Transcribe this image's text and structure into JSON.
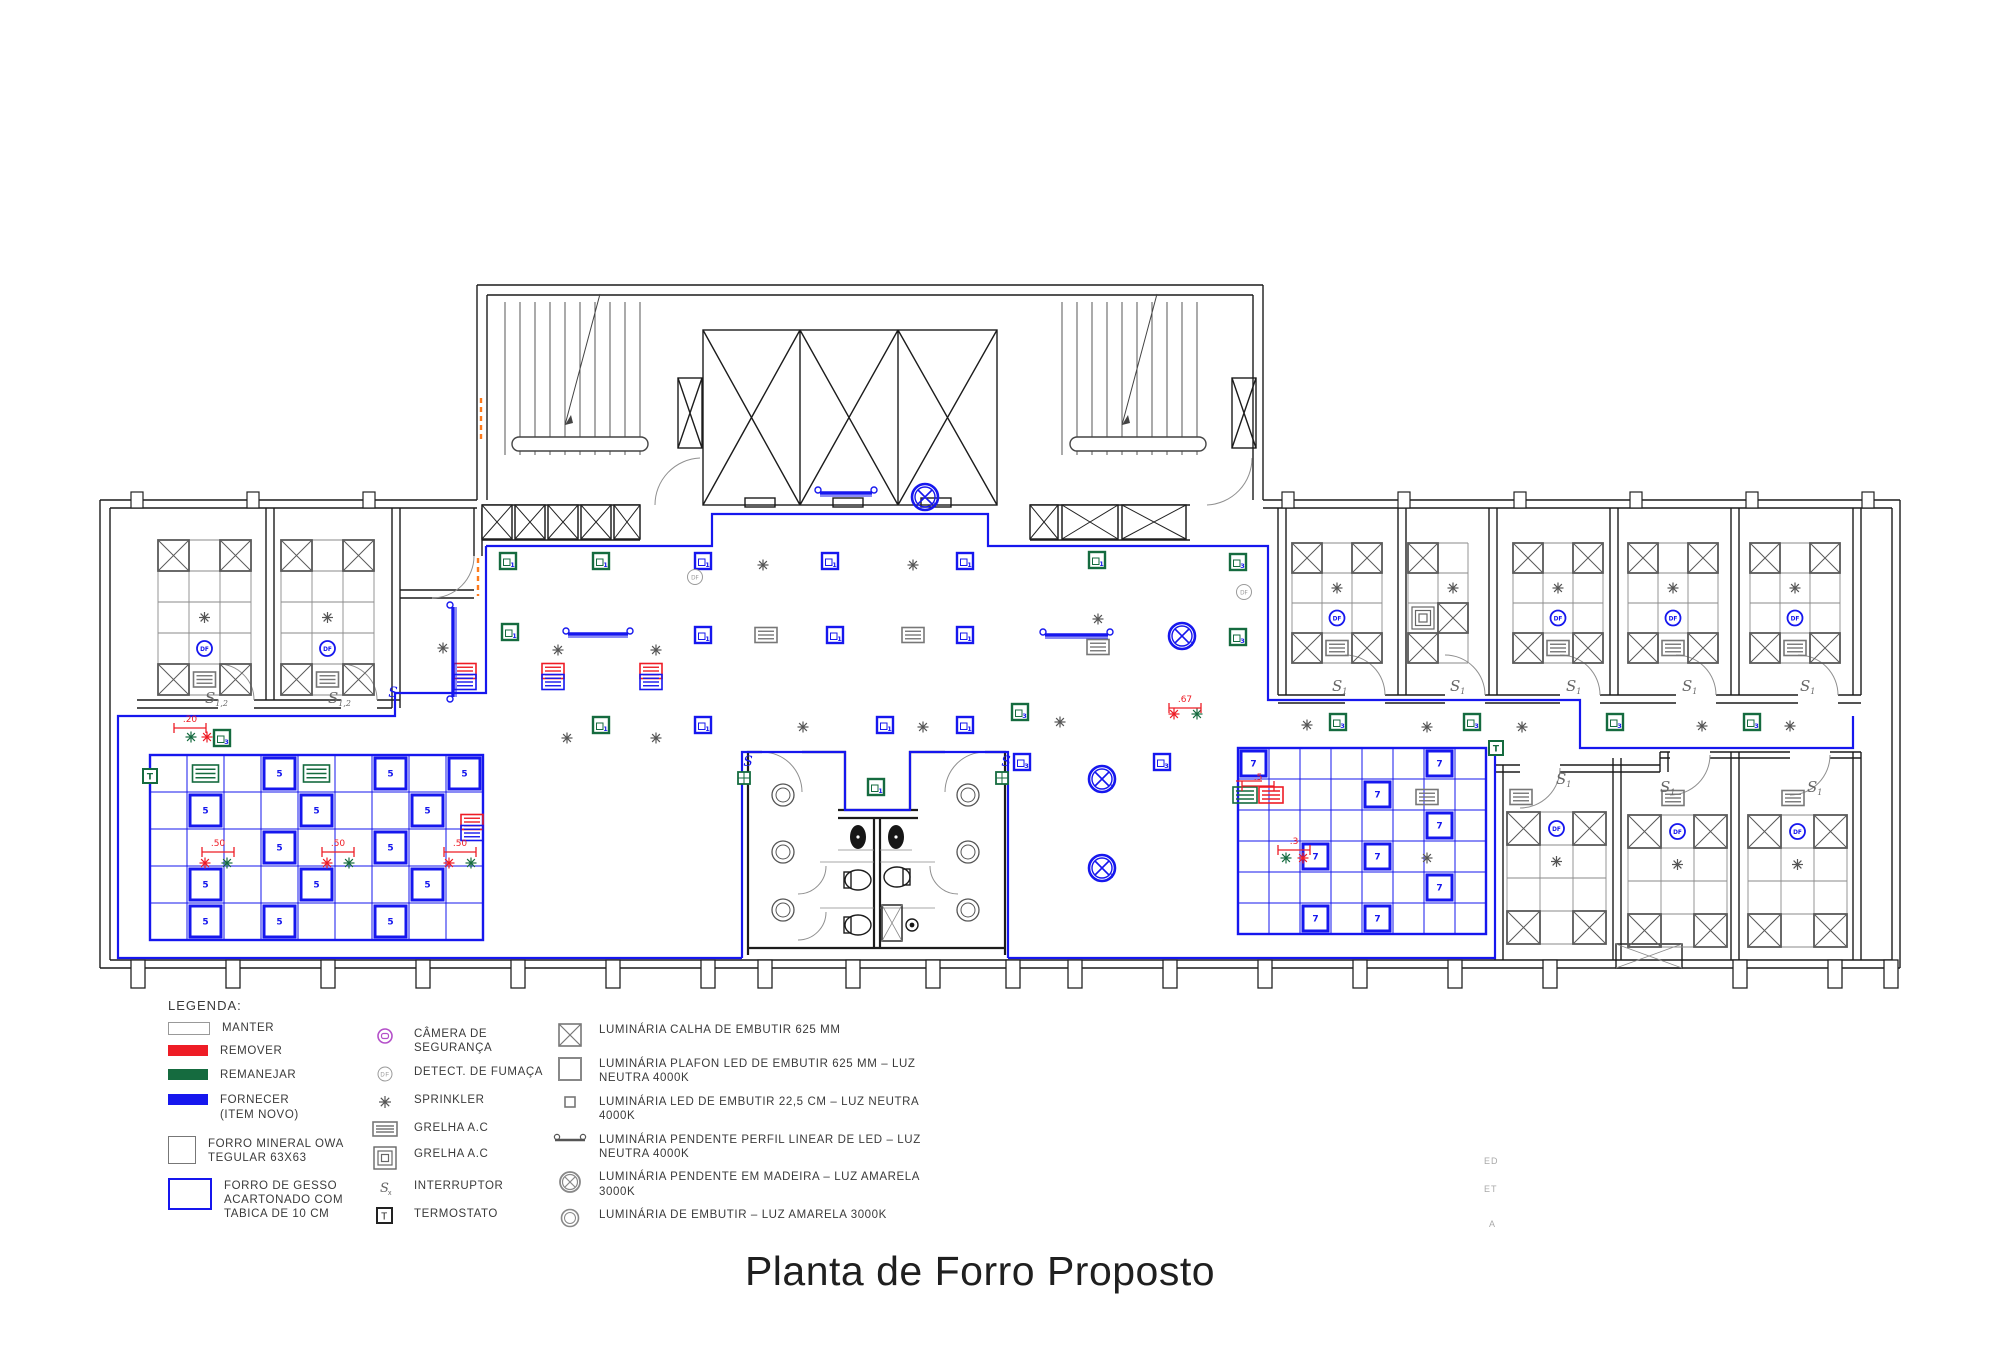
{
  "title": "Planta de Forro Proposto",
  "stray_labels": [
    {
      "text": "ED",
      "x": 1484,
      "y": 1156
    },
    {
      "text": "ET",
      "x": 1484,
      "y": 1184
    },
    {
      "text": "A",
      "x": 1489,
      "y": 1219
    }
  ],
  "colors": {
    "blue": "#1617ee",
    "green": "#156b3f",
    "red": "#ee1c25",
    "gray": "#6e6e6e",
    "wall": "#1c1c1c",
    "purple": "#b44fc9",
    "orange": "#ff7a1a"
  },
  "legend": {
    "heading": "LEGENDA:",
    "status": [
      {
        "key": "manter",
        "label": "MANTER"
      },
      {
        "key": "remover",
        "label": "REMOVER"
      },
      {
        "key": "remanejar",
        "label": "REMANEJAR"
      },
      {
        "key": "fornecer",
        "label": "FORNECER\n(ITEM NOVO)"
      },
      {
        "key": "forro_mineral",
        "label": "FORRO MINERAL OWA\nTEGULAR 63X63"
      },
      {
        "key": "forro_gesso",
        "label": "FORRO DE GESSO\nACARTONADO COM\nTABICA DE 10 CM"
      }
    ],
    "devices": [
      {
        "icon": "camera",
        "label": "CÂMERA DE SEGURANÇA"
      },
      {
        "icon": "df",
        "label": "DETECT. DE FUMAÇA"
      },
      {
        "icon": "sprinkler",
        "label": "SPRINKLER"
      },
      {
        "icon": "grelha",
        "label": "GRELHA A.C"
      },
      {
        "icon": "grelha_sq",
        "label": "GRELHA A.C"
      },
      {
        "icon": "interruptor",
        "label": "INTERRUPTOR"
      },
      {
        "icon": "termostato",
        "label": "TERMOSTATO"
      }
    ],
    "luminaires": [
      {
        "icon": "calha",
        "label": "LUMINÁRIA CALHA DE EMBUTIR 625 MM"
      },
      {
        "icon": "plafon",
        "label": "LUMINÁRIA PLAFON LED DE EMBUTIR 625 MM – LUZ\nNEUTRA 4000K"
      },
      {
        "icon": "led225",
        "label": "LUMINÁRIA LED DE EMBUTIR 22,5 CM – LUZ NEUTRA\n4000K"
      },
      {
        "icon": "pend_linear",
        "label": "LUMINÁRIA PENDENTE PERFIL LINEAR DE LED – LUZ\nNEUTRA 4000K"
      },
      {
        "icon": "pend_madeira",
        "label": "LUMINÁRIA PENDENTE EM MADEIRA – LUZ AMARELA\n3000K"
      },
      {
        "icon": "embutir_amarela",
        "label": "LUMINÁRIA DE EMBUTIR – LUZ AMARELA 3000K"
      }
    ]
  },
  "plan": {
    "rooms": [
      {
        "x": 158,
        "y": 540,
        "t": 31,
        "c": 3,
        "r": 5,
        "pat": "A"
      },
      {
        "x": 281,
        "y": 540,
        "t": 31,
        "c": 3,
        "r": 5,
        "pat": "A"
      },
      {
        "x": 1292,
        "y": 543,
        "t": 30,
        "c": 3,
        "r": 4,
        "pat": "M"
      },
      {
        "x": 1408,
        "y": 543,
        "t": 30,
        "c": 2,
        "r": 4,
        "pat": "M2"
      },
      {
        "x": 1513,
        "y": 543,
        "t": 30,
        "c": 3,
        "r": 4,
        "pat": "M"
      },
      {
        "x": 1628,
        "y": 543,
        "t": 30,
        "c": 3,
        "r": 4,
        "pat": "M"
      },
      {
        "x": 1750,
        "y": 543,
        "t": 30,
        "c": 3,
        "r": 4,
        "pat": "M"
      },
      {
        "x": 1507,
        "y": 812,
        "t": 33,
        "c": 3,
        "r": 4,
        "pat": "B"
      },
      {
        "x": 1628,
        "y": 815,
        "t": 33,
        "c": 3,
        "r": 4,
        "pat": "B"
      },
      {
        "x": 1748,
        "y": 815,
        "t": 33,
        "c": 3,
        "r": 4,
        "pat": "B"
      }
    ],
    "gesso_grids": [
      {
        "x": 150,
        "y": 755,
        "tile": 37,
        "cols": 9,
        "rows": 5,
        "num": "5",
        "bold": [
          [
            0,
            3
          ],
          [
            0,
            6
          ],
          [
            0,
            8
          ],
          [
            1,
            1
          ],
          [
            1,
            4
          ],
          [
            1,
            7
          ],
          [
            2,
            3
          ],
          [
            2,
            6
          ],
          [
            3,
            1
          ],
          [
            3,
            4
          ],
          [
            3,
            7
          ],
          [
            4,
            1
          ],
          [
            4,
            3
          ],
          [
            4,
            6
          ]
        ],
        "green_grelhas": [
          [
            0,
            1
          ],
          [
            0,
            4
          ]
        ]
      },
      {
        "x": 1238,
        "y": 748,
        "tile": 31,
        "cols": 8,
        "rows": 6,
        "num": "7",
        "bold": [
          [
            0,
            0
          ],
          [
            0,
            6
          ],
          [
            1,
            4
          ],
          [
            2,
            6
          ],
          [
            3,
            2
          ],
          [
            3,
            4
          ],
          [
            4,
            6
          ],
          [
            5,
            2
          ],
          [
            5,
            4
          ]
        ],
        "green_grelhas": []
      }
    ],
    "squares": [
      {
        "c": "g",
        "n": "1",
        "x": 508,
        "y": 561
      },
      {
        "c": "g",
        "n": "1",
        "x": 601,
        "y": 561
      },
      {
        "c": "g",
        "n": "1",
        "x": 510,
        "y": 632
      },
      {
        "c": "g",
        "n": "1",
        "x": 601,
        "y": 725
      },
      {
        "c": "g",
        "n": "1",
        "x": 876,
        "y": 787
      },
      {
        "c": "g",
        "n": "1",
        "x": 1097,
        "y": 560
      },
      {
        "c": "g",
        "n": "3",
        "x": 222,
        "y": 738
      },
      {
        "c": "g",
        "n": "3",
        "x": 1020,
        "y": 712
      },
      {
        "c": "g",
        "n": "3",
        "x": 1238,
        "y": 562
      },
      {
        "c": "g",
        "n": "3",
        "x": 1238,
        "y": 637
      },
      {
        "c": "g",
        "n": "3",
        "x": 1338,
        "y": 722
      },
      {
        "c": "g",
        "n": "3",
        "x": 1472,
        "y": 722
      },
      {
        "c": "g",
        "n": "3",
        "x": 1615,
        "y": 722
      },
      {
        "c": "g",
        "n": "3",
        "x": 1752,
        "y": 722
      },
      {
        "c": "b",
        "n": "1",
        "x": 703,
        "y": 561
      },
      {
        "c": "b",
        "n": "1",
        "x": 830,
        "y": 561
      },
      {
        "c": "b",
        "n": "1",
        "x": 965,
        "y": 561
      },
      {
        "c": "b",
        "n": "1",
        "x": 703,
        "y": 635
      },
      {
        "c": "b",
        "n": "1",
        "x": 835,
        "y": 635
      },
      {
        "c": "b",
        "n": "1",
        "x": 965,
        "y": 635
      },
      {
        "c": "b",
        "n": "1",
        "x": 703,
        "y": 725
      },
      {
        "c": "b",
        "n": "1",
        "x": 885,
        "y": 725
      },
      {
        "c": "b",
        "n": "1",
        "x": 965,
        "y": 725
      },
      {
        "c": "b",
        "n": "3",
        "x": 1022,
        "y": 762
      },
      {
        "c": "b",
        "n": "3",
        "x": 1162,
        "y": 762
      }
    ],
    "sprinklers": [
      {
        "c": "gray",
        "x": 763,
        "y": 565
      },
      {
        "c": "gray",
        "x": 913,
        "y": 565
      },
      {
        "c": "gray",
        "x": 443,
        "y": 648
      },
      {
        "c": "gray",
        "x": 558,
        "y": 650
      },
      {
        "c": "gray",
        "x": 656,
        "y": 650
      },
      {
        "c": "gray",
        "x": 567,
        "y": 738
      },
      {
        "c": "gray",
        "x": 656,
        "y": 738
      },
      {
        "c": "gray",
        "x": 803,
        "y": 727
      },
      {
        "c": "gray",
        "x": 923,
        "y": 727
      },
      {
        "c": "gray",
        "x": 1098,
        "y": 619
      },
      {
        "c": "gray",
        "x": 1060,
        "y": 722
      },
      {
        "c": "gray",
        "x": 1307,
        "y": 725
      },
      {
        "c": "gray",
        "x": 1427,
        "y": 727
      },
      {
        "c": "gray",
        "x": 1522,
        "y": 727
      },
      {
        "c": "gray",
        "x": 1702,
        "y": 726
      },
      {
        "c": "gray",
        "x": 1790,
        "y": 726
      },
      {
        "c": "gray",
        "x": 1427,
        "y": 858
      },
      {
        "c": "red",
        "x": 207,
        "y": 737
      },
      {
        "c": "red",
        "x": 205,
        "y": 863
      },
      {
        "c": "red",
        "x": 327,
        "y": 863
      },
      {
        "c": "red",
        "x": 449,
        "y": 863
      },
      {
        "c": "red",
        "x": 1303,
        "y": 858
      },
      {
        "c": "red",
        "x": 1174,
        "y": 714
      },
      {
        "c": "green",
        "x": 191,
        "y": 737
      },
      {
        "c": "green",
        "x": 227,
        "y": 863
      },
      {
        "c": "green",
        "x": 349,
        "y": 863
      },
      {
        "c": "green",
        "x": 471,
        "y": 863
      },
      {
        "c": "green",
        "x": 1286,
        "y": 858
      },
      {
        "c": "green",
        "x": 1197,
        "y": 714
      }
    ],
    "detectors": [
      {
        "c": "gray",
        "x": 695,
        "y": 577
      },
      {
        "c": "gray",
        "x": 1244,
        "y": 592
      }
    ],
    "grelhas": [
      {
        "c": "gray",
        "x": 766,
        "y": 635
      },
      {
        "c": "gray",
        "x": 913,
        "y": 635
      },
      {
        "c": "gray",
        "x": 1098,
        "y": 647
      },
      {
        "c": "gray",
        "x": 1427,
        "y": 797
      },
      {
        "c": "gray",
        "x": 1521,
        "y": 797
      },
      {
        "c": "gray",
        "x": 1673,
        "y": 798
      },
      {
        "c": "gray",
        "x": 1793,
        "y": 798
      }
    ],
    "grelha_pairs_redblue": [
      {
        "x": 465,
        "y": 677
      },
      {
        "x": 553,
        "y": 677
      },
      {
        "x": 651,
        "y": 677
      },
      {
        "x": 472,
        "y": 828
      }
    ],
    "grelha_pairs_greenred": [
      {
        "x": 1258,
        "y": 795
      }
    ],
    "pendants_h": [
      {
        "x1": 568,
        "x2": 628,
        "y": 634
      },
      {
        "x1": 820,
        "x2": 872,
        "y": 493
      },
      {
        "x1": 1045,
        "x2": 1108,
        "y": 635
      }
    ],
    "pendants_v": [
      {
        "x": 453,
        "y1": 607,
        "y2": 697
      }
    ],
    "pendants_round": [
      {
        "x": 925,
        "y": 497,
        "n": "2"
      },
      {
        "x": 1182,
        "y": 636,
        "n": "2"
      },
      {
        "x": 1102,
        "y": 779,
        "n": "2"
      },
      {
        "x": 1102,
        "y": 868,
        "n": "2"
      }
    ],
    "round_lights": [
      {
        "x": 783,
        "y": 795
      },
      {
        "x": 783,
        "y": 852
      },
      {
        "x": 783,
        "y": 910
      },
      {
        "x": 968,
        "y": 795
      },
      {
        "x": 968,
        "y": 852
      },
      {
        "x": 968,
        "y": 910
      }
    ],
    "dimensions": [
      {
        "x": 218,
        "y": 846,
        "l": ".50"
      },
      {
        "x": 338,
        "y": 846,
        "l": ".50"
      },
      {
        "x": 460,
        "y": 846,
        "l": ".50"
      },
      {
        "x": 190,
        "y": 722,
        "l": ".20"
      },
      {
        "x": 1258,
        "y": 780,
        "l": ".5"
      },
      {
        "x": 1294,
        "y": 844,
        "l": ".3"
      },
      {
        "x": 1185,
        "y": 702,
        "l": ".67"
      }
    ],
    "switch_labels": [
      {
        "x": 205,
        "y": 703,
        "t": "S",
        "s": "1,2"
      },
      {
        "x": 328,
        "y": 703,
        "t": "S",
        "s": "1,2"
      },
      {
        "x": 1332,
        "y": 691,
        "t": "S",
        "s": "1"
      },
      {
        "x": 1450,
        "y": 691,
        "t": "S",
        "s": "1"
      },
      {
        "x": 1566,
        "y": 691,
        "t": "S",
        "s": "1"
      },
      {
        "x": 1682,
        "y": 691,
        "t": "S",
        "s": "1"
      },
      {
        "x": 1800,
        "y": 691,
        "t": "S",
        "s": "1"
      },
      {
        "x": 1556,
        "y": 784,
        "t": "S",
        "s": "1"
      },
      {
        "x": 1660,
        "y": 792,
        "t": "S",
        "s": "1"
      },
      {
        "x": 1807,
        "y": 792,
        "t": "S",
        "s": "1"
      }
    ],
    "thermostats": [
      {
        "x": 150,
        "y": 776
      },
      {
        "x": 1496,
        "y": 748
      }
    ],
    "green_boxes": [
      {
        "x": 744,
        "y": 778
      },
      {
        "x": 1002,
        "y": 778
      }
    ],
    "s_glyphs": [
      {
        "x": 393,
        "y": 697
      },
      {
        "x": 748,
        "y": 766
      },
      {
        "x": 1006,
        "y": 766
      }
    ]
  }
}
